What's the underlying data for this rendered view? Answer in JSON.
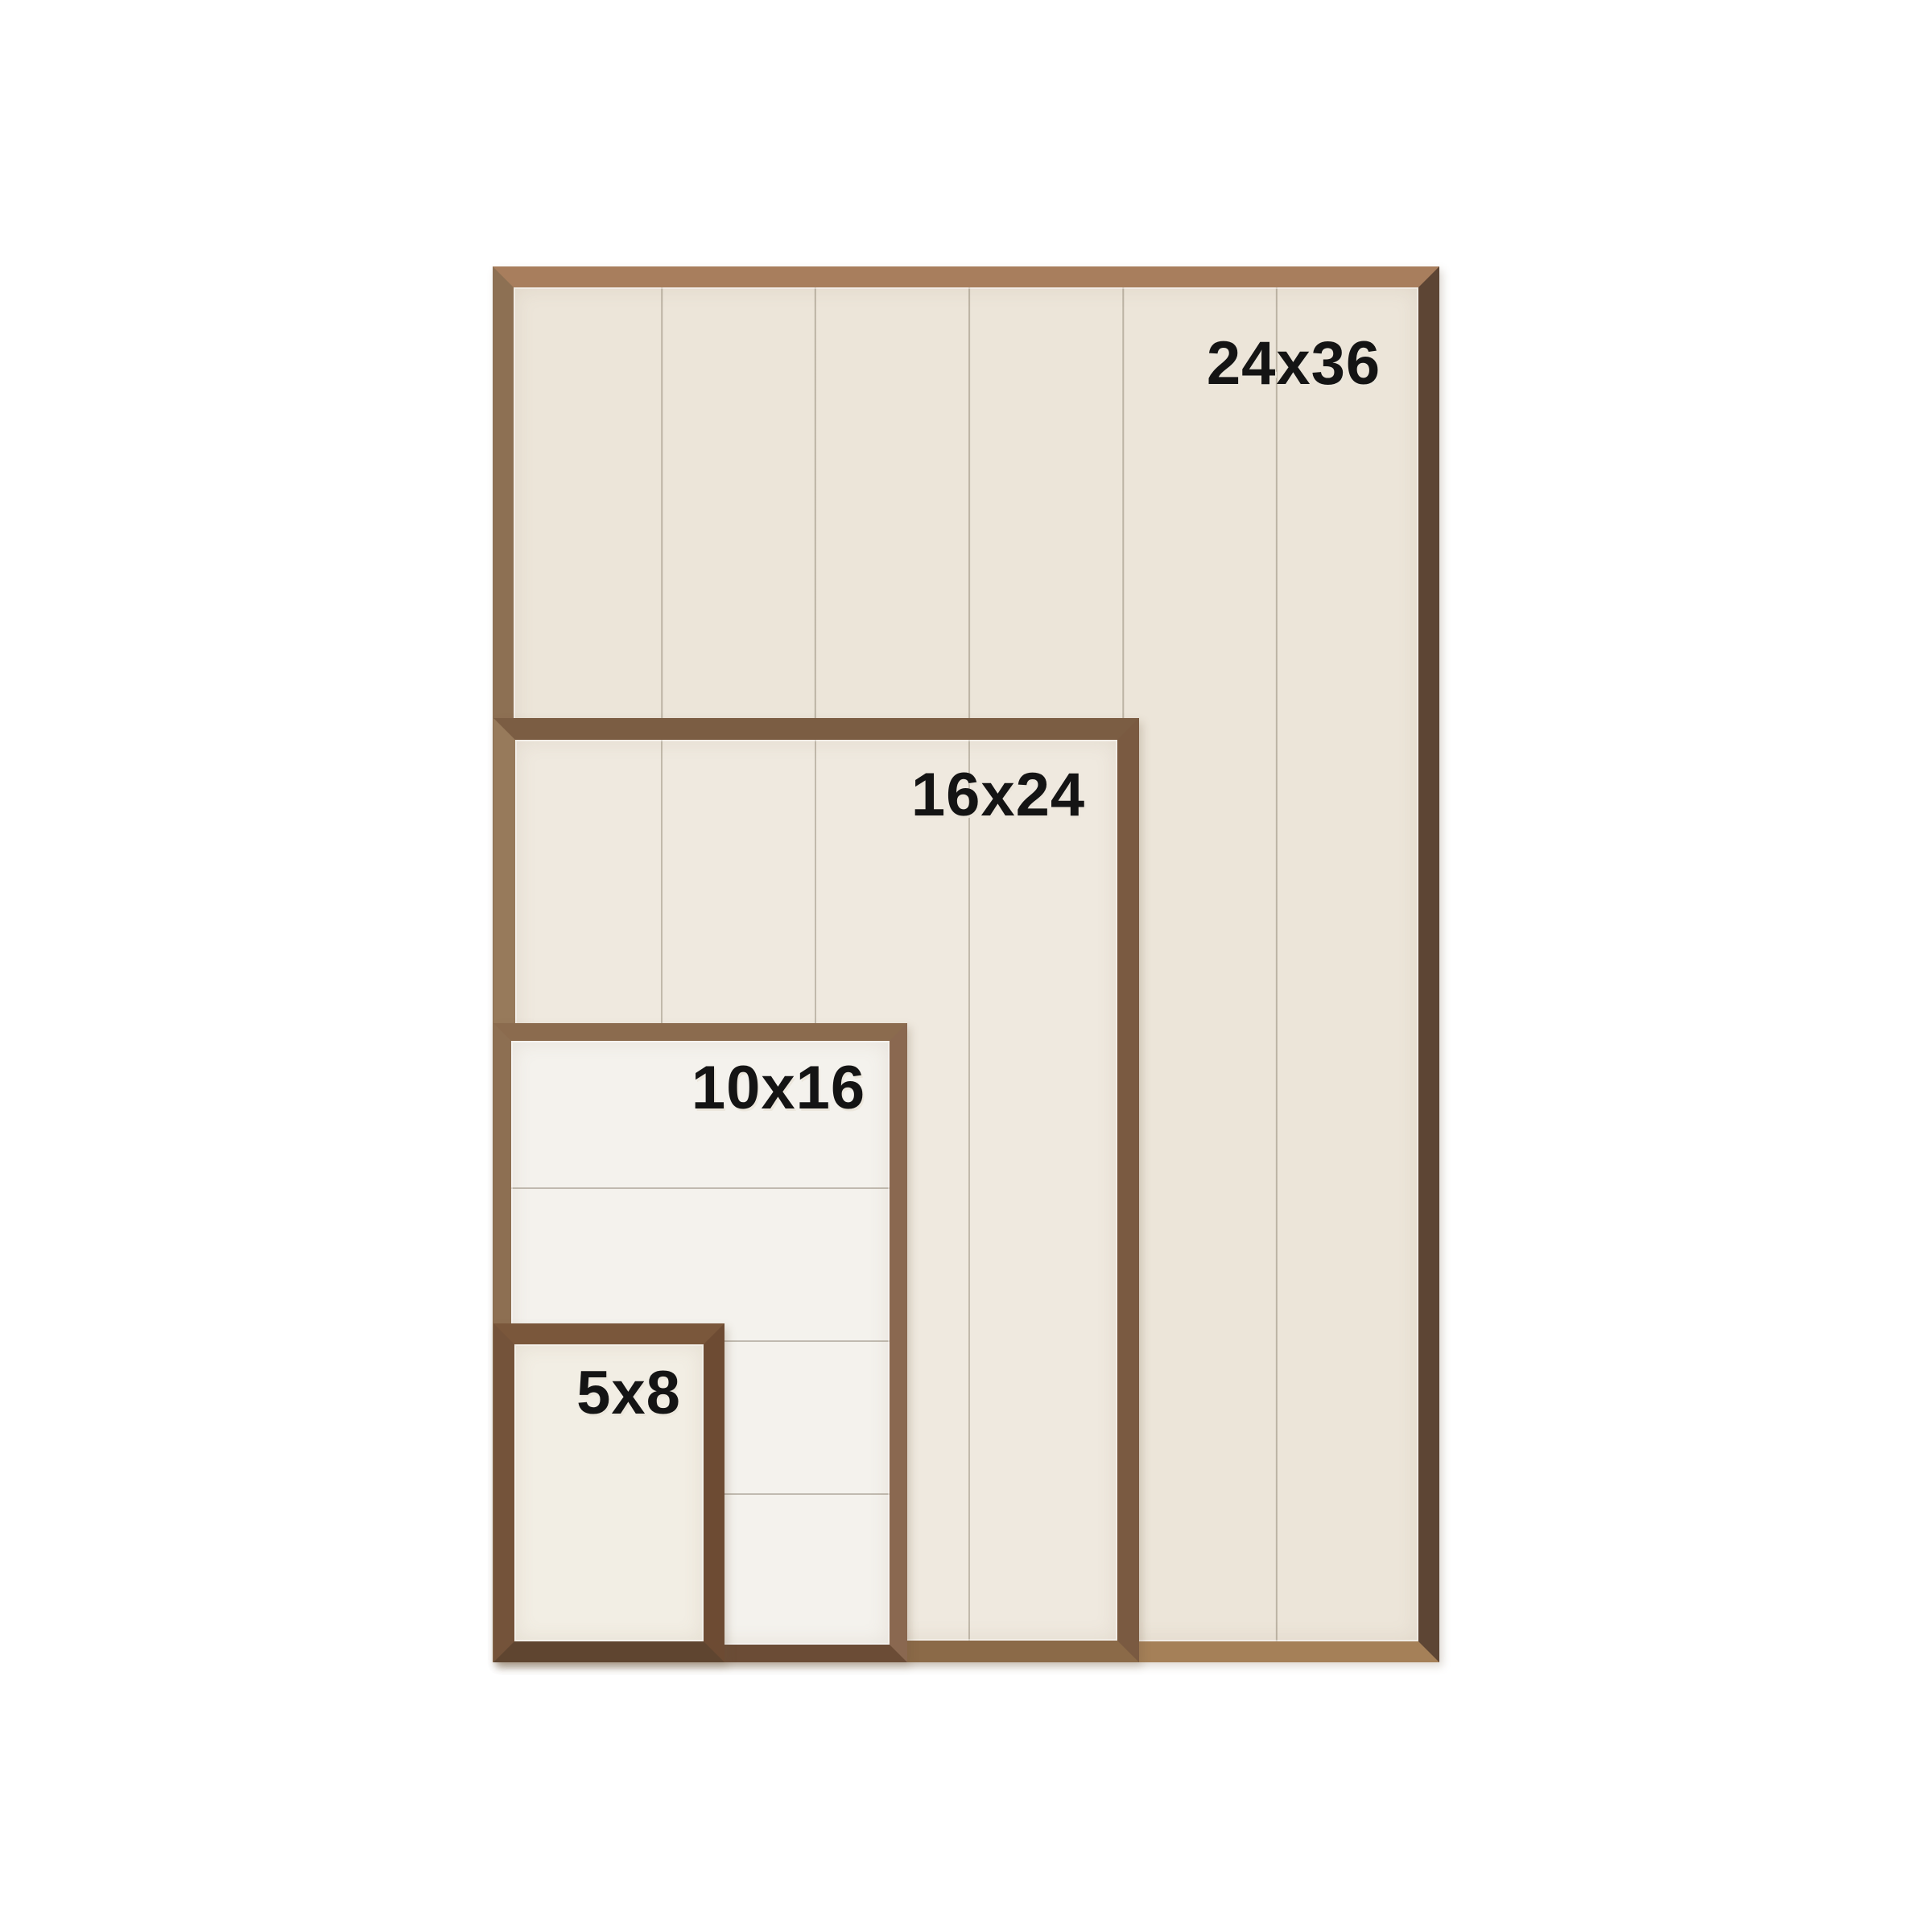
{
  "page": {
    "background_color": "#ffffff",
    "content": "nested wood frame size comparison"
  },
  "frames": [
    {
      "label": "24x36"
    },
    {
      "label": "16x24"
    },
    {
      "label": "10x16"
    },
    {
      "label": "5x8"
    }
  ],
  "colors": {
    "background": "#ffffff",
    "label_text": "#141414",
    "wood_light_tan": "#a87e5d",
    "wood_medium_brown": "#8a6a4e",
    "wood_dark_brown": "#5d4534",
    "wood_rustic_dark": "#6d4b33",
    "panel_cream": "#ece5d9",
    "panel_light_cream": "#efe9df",
    "panel_white": "#f4f2ed",
    "plank_seam_line": "#948a78"
  }
}
